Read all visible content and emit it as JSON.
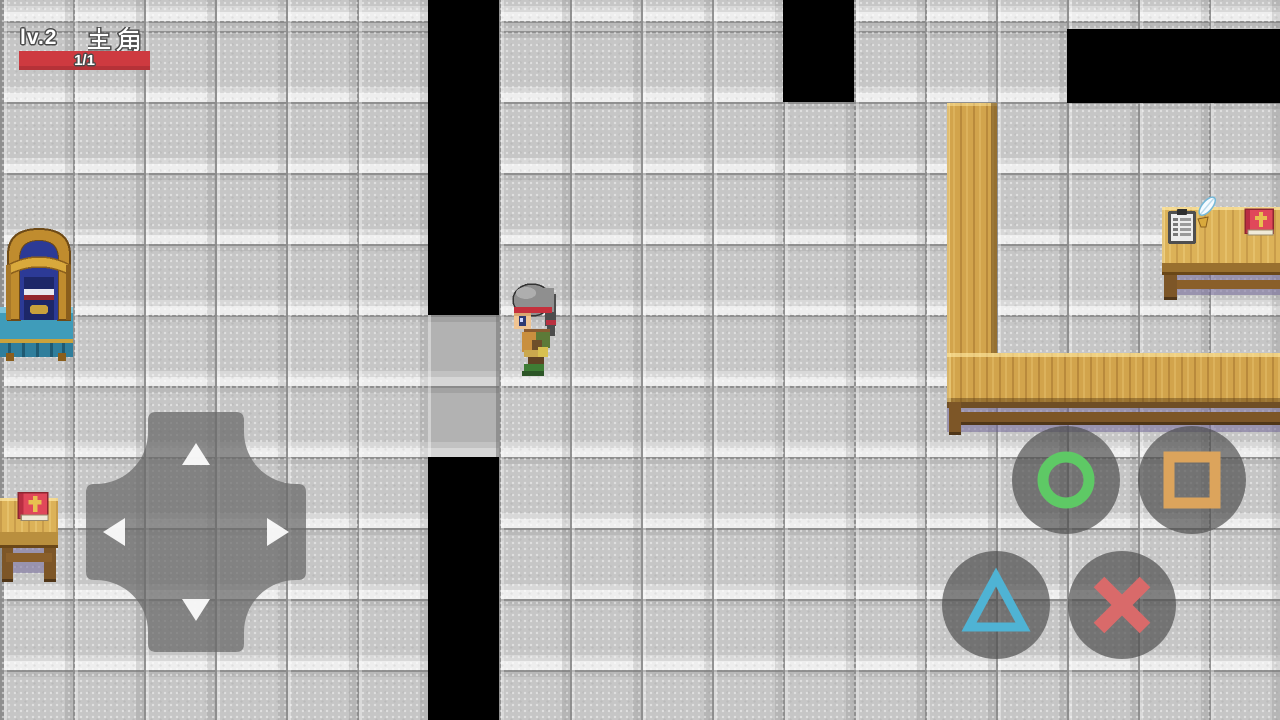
{
  "hud": {
    "level_label": "lv.2",
    "player_name": "主角",
    "hp_text": "1/1",
    "hp_bar_color": "#ce3a40"
  },
  "controls": {
    "dpad": {
      "color": "rgba(104,104,104,0.72)",
      "arrow_color": "rgba(255,255,255,0.92)",
      "directions": [
        "up",
        "left",
        "right",
        "down"
      ]
    },
    "buttons": [
      {
        "id": "circle",
        "glyph": "ring",
        "color": "#5ec965"
      },
      {
        "id": "square",
        "glyph": "square",
        "color": "#dca45c"
      },
      {
        "id": "triangle",
        "glyph": "triangle",
        "color": "#4fb3d4"
      },
      {
        "id": "cross",
        "glyph": "x",
        "color": "#d96a6a"
      }
    ]
  },
  "palette": {
    "floor_tile": "#c6c6c6",
    "tile_grid": "#8f8f8f",
    "void": "#000000",
    "door_tile": "#b2b2b2",
    "wood": "#d2a44c",
    "furniture_shadow": "#6c6096"
  },
  "scene": {
    "objects": [
      "canopy-bed",
      "doorway-tiles",
      "hero-sprite",
      "left-table-with-bible",
      "wooden-counter-L",
      "right-desk-with-clipboard-quill-bible"
    ]
  }
}
